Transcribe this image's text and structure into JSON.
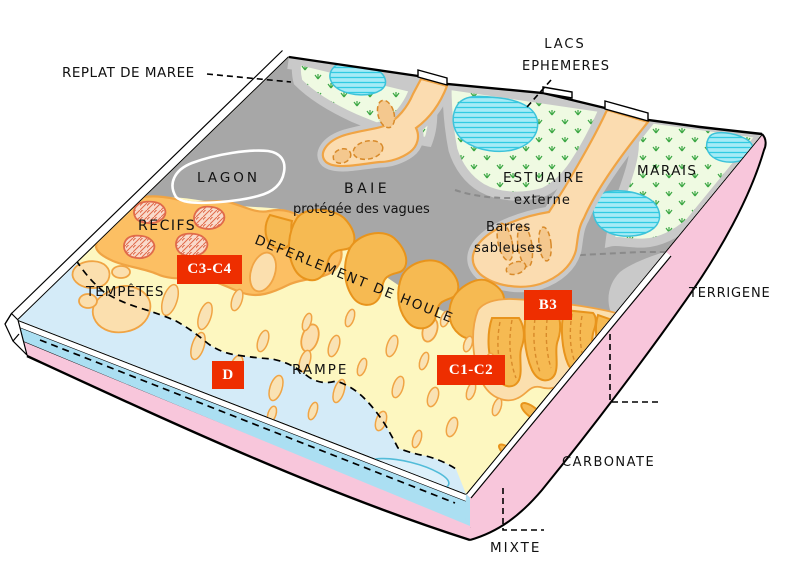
{
  "labels": {
    "replat_de_maree": "REPLAT DE MAREE",
    "lacs_line1": "LACS",
    "lacs_line2": "EPHEMERES",
    "lagon": "LAGON",
    "baie": "BAIE",
    "baie_sub": "protégée des vagues",
    "estuaire": "ESTUAIRE",
    "estuaire_sub": "externe",
    "marais": "MARAIS",
    "recifs": "RECIFS",
    "barres_line1": "Barres",
    "barres_line2": "sableuses",
    "deferlement": "DEFERLEMENT DE HOULE",
    "tempetes": "TEMPÊTES",
    "rampe": "RAMPE",
    "terrigene": "TERRIGENE",
    "carbonate": "CARBONATE",
    "mixte": "MIXTE"
  },
  "zone_codes": {
    "reef": "C3-C4",
    "estuary_mouth": "B3",
    "outer_ramp": "D",
    "inner_ramp": "C1-C2"
  },
  "colors": {
    "bay_gray": "#a7a7a7",
    "tidal_flat_gray": "#c9c9c9",
    "marsh_green_bg": "#effae2",
    "marsh_grass": "#3da845",
    "lake_cyan": "#a5ebf6",
    "lake_stripe": "#30cbe2",
    "lake_edge": "#3cc3da",
    "estuary_sand": "#fbdcb0",
    "sand_outline": "#f0a444",
    "sand_bar": "#f4c88e",
    "sand_bar_line": "#d88a2a",
    "reef_orange": "#fcbf63",
    "reef_patch_pink": "#f9dacb",
    "reef_patch_line": "#e06a4a",
    "surf_lobe": "#f6ba52",
    "surf_lobe_line": "#e8941c",
    "pale_lobe": "#fbdfae",
    "ramp_yellow": "#fdf7c0",
    "ramp_blob": "#f9e2b4",
    "sea_blue": "#d4ebf8",
    "sea_lobe": "#ddf0fa",
    "sea_lobe_line": "#52bcd9",
    "front_blue": "#abdff2",
    "side_pink": "#f8c6db",
    "gray_dash": "#8a8a8a",
    "code_box_red": "#ee2e00",
    "code_box_text": "#ffffff"
  }
}
